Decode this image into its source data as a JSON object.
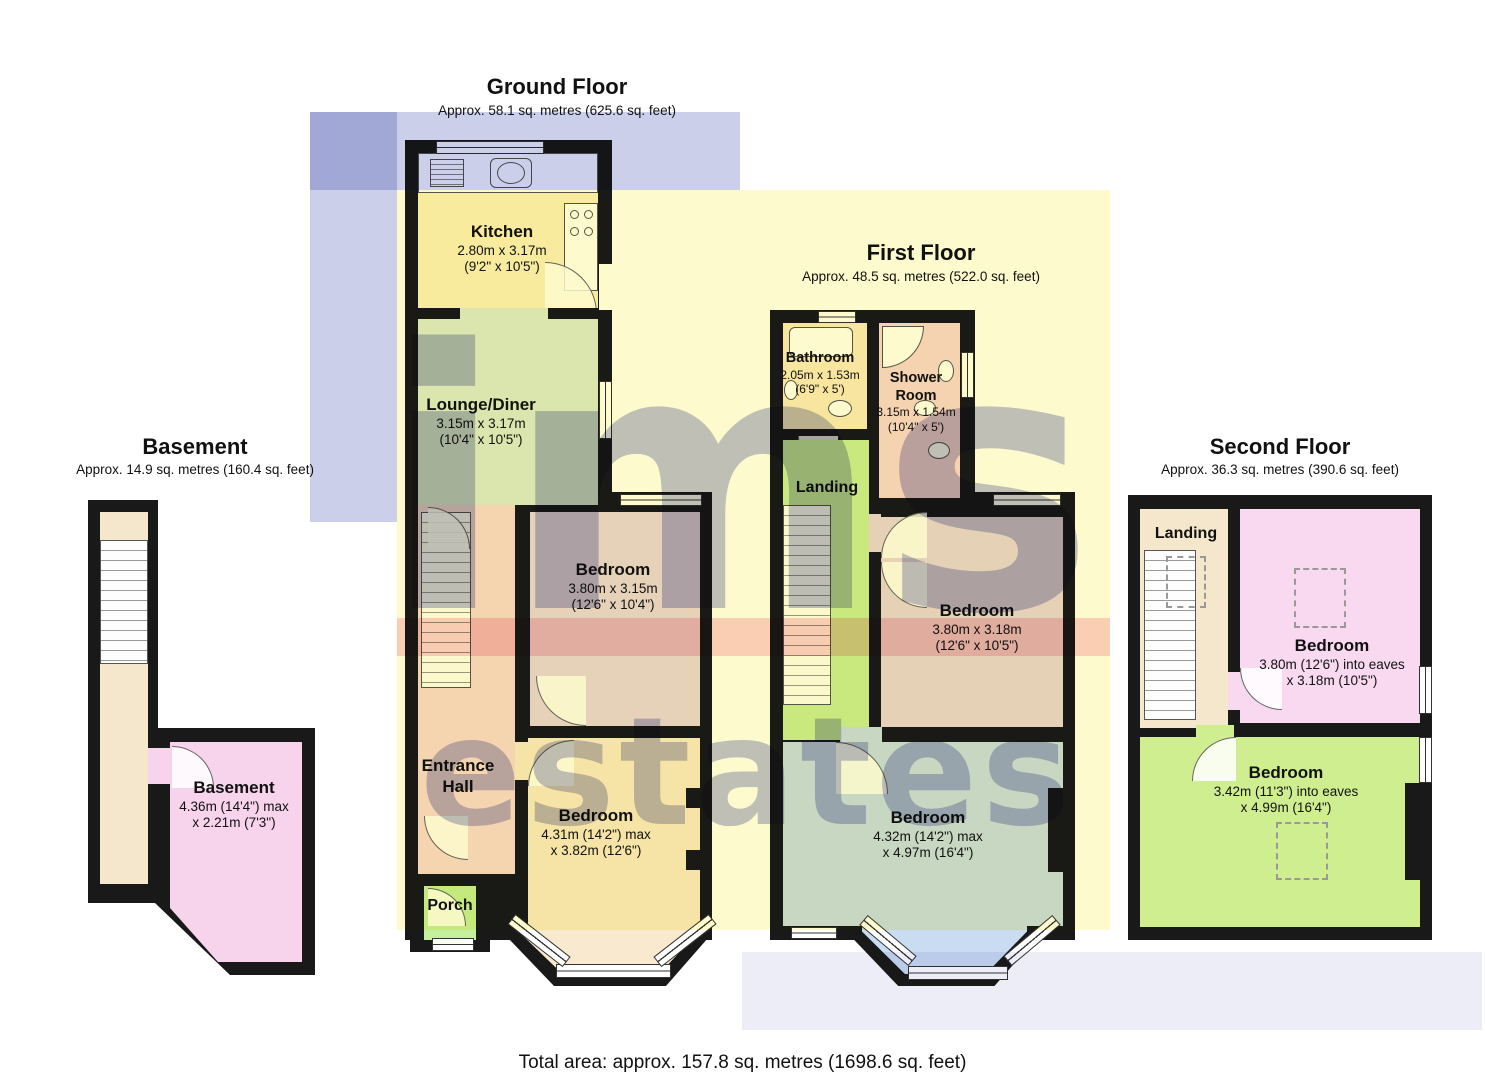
{
  "watermark": {
    "line1": "ims",
    "line2": "estates"
  },
  "footer": {
    "total_area": "Total area: approx. 157.8 sq. metres (1698.6 sq. feet)"
  },
  "colors": {
    "wall": "#191919",
    "kitchen": "#FAF0C4",
    "lounge": "#DCEBD8",
    "bedroom_mauve": "#E7D7E7",
    "hall_pink": "#F6DADB",
    "bedroom_cream": "#F8E9CF",
    "porch_green": "#C6EF9D",
    "bathroom_cream": "#FAEBC6",
    "shower_pink": "#F7D7DB",
    "landing_green": "#CBEE9E",
    "bedroom_blue": "#C9DCF2",
    "landing_cream": "#F5E7CC",
    "bedroom_pink": "#F9D9F0",
    "bedroom_green": "#CFEE8F",
    "basement_pink": "#F7D3EC",
    "overlay_lavender": "#C8CCE8",
    "overlay_yellow": "#FDF9C8",
    "overlay_pink": "#F7A6BE",
    "watermark_blue": "#6468B6"
  },
  "floors": {
    "basement": {
      "title": "Basement",
      "subtitle": "Approx. 14.9 sq. metres (160.4 sq. feet)",
      "rooms": {
        "basement": {
          "name": "Basement",
          "dim1": "4.36m (14'4\") max",
          "dim2": "x 2.21m (7'3\")"
        }
      }
    },
    "ground": {
      "title": "Ground Floor",
      "subtitle": "Approx. 58.1 sq. metres (625.6 sq. feet)",
      "rooms": {
        "kitchen": {
          "name": "Kitchen",
          "dim1": "2.80m x 3.17m",
          "dim2": "(9'2\" x 10'5\")"
        },
        "lounge": {
          "name": "Lounge/Diner",
          "dim1": "3.15m x 3.17m",
          "dim2": "(10'4\" x 10'5\")"
        },
        "bedroom_mid": {
          "name": "Bedroom",
          "dim1": "3.80m x 3.15m",
          "dim2": "(12'6\" x 10'4\")"
        },
        "entrance_hall": {
          "name": "Entrance Hall"
        },
        "bedroom_front": {
          "name": "Bedroom",
          "dim1": "4.31m (14'2\") max",
          "dim2": "x 3.82m (12'6\")"
        },
        "porch": {
          "name": "Porch"
        }
      }
    },
    "first": {
      "title": "First Floor",
      "subtitle": "Approx. 48.5 sq. metres (522.0 sq. feet)",
      "rooms": {
        "bathroom": {
          "name": "Bathroom",
          "dim1": "2.05m x 1.53m",
          "dim2": "(6'9\" x 5')"
        },
        "shower": {
          "name": "Shower Room",
          "dim1": "3.15m x 1.54m",
          "dim2": "(10'4\" x 5')"
        },
        "landing": {
          "name": "Landing"
        },
        "bedroom_mid": {
          "name": "Bedroom",
          "dim1": "3.80m x 3.18m",
          "dim2": "(12'6\" x 10'5\")"
        },
        "bedroom_front": {
          "name": "Bedroom",
          "dim1": "4.32m (14'2\") max",
          "dim2": "x 4.97m (16'4\")"
        }
      }
    },
    "second": {
      "title": "Second Floor",
      "subtitle": "Approx. 36.3 sq. metres (390.6 sq. feet)",
      "rooms": {
        "landing": {
          "name": "Landing"
        },
        "bedroom_pink": {
          "name": "Bedroom",
          "dim1": "3.80m (12'6\") into eaves",
          "dim2": "x 3.18m (10'5\")"
        },
        "bedroom_green": {
          "name": "Bedroom",
          "dim1": "3.42m (11'3\") into eaves",
          "dim2": "x 4.99m (16'4\")"
        }
      }
    }
  }
}
